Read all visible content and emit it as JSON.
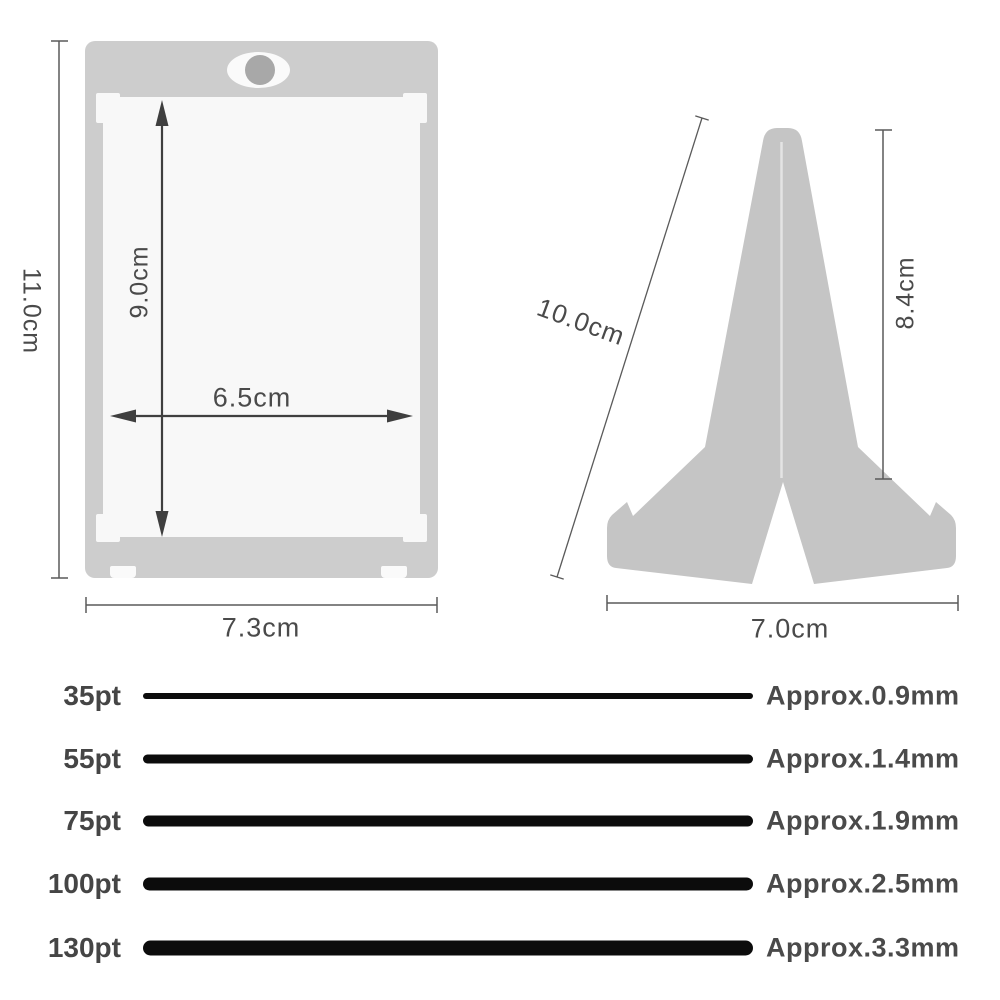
{
  "card_holder": {
    "outer_height": "11.0cm",
    "inner_height": "9.0cm",
    "inner_width": "6.5cm",
    "outer_width": "7.3cm"
  },
  "stand": {
    "slant_length": "10.0cm",
    "height": "8.4cm",
    "base_width": "7.0cm"
  },
  "thickness_chart": {
    "rows": [
      {
        "pt": "35pt",
        "mm": "Approx.0.9mm"
      },
      {
        "pt": "55pt",
        "mm": "Approx.1.4mm"
      },
      {
        "pt": "75pt",
        "mm": "Approx.1.9mm"
      },
      {
        "pt": "100pt",
        "mm": "Approx.2.5mm"
      },
      {
        "pt": "130pt",
        "mm": "Approx.3.3mm"
      }
    ],
    "bar_heights_px": [
      6,
      9,
      11,
      13,
      15
    ]
  },
  "colors": {
    "card_gray": "#cdcdcd",
    "inner_white": "#f8f8f8",
    "stand_gray": "#c5c5c5",
    "bar_black": "#0c0c0c",
    "label_gray": "#4a4a4a"
  }
}
